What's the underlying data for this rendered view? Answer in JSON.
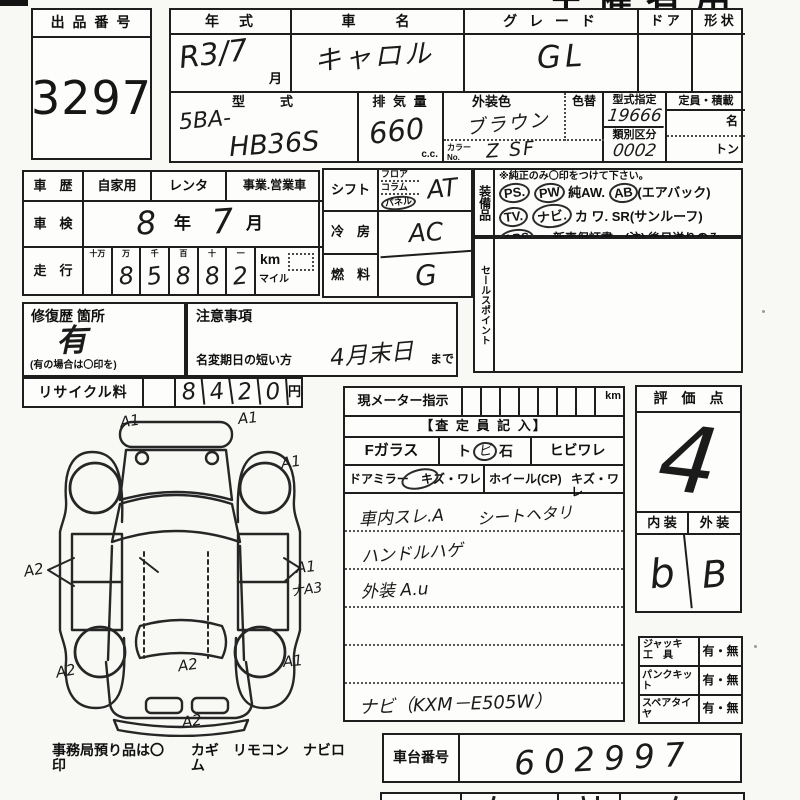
{
  "page": {
    "cut_title": "主催者用"
  },
  "lot": {
    "label": "出 品 番 号",
    "number": "3297"
  },
  "vehicle": {
    "year_label": "年　式",
    "year_value": "R3/7",
    "year_unit": "月",
    "name_label": "車　　名",
    "name_value": "キャロル",
    "grade_label": "グ レ ー ド",
    "grade_value": "GL",
    "door_label": "ド ア",
    "shape_label": "形 状",
    "model_label": "型　　式",
    "model_prefix": "5BA-",
    "model_code": "HB36S",
    "disp_label": "排 気 量",
    "disp_value": "660",
    "disp_unit": "c.c.",
    "color_label": "外装色",
    "color_change_label": "色替",
    "color_value": "ブラウン",
    "color_no_label": "カラーNo.",
    "color_no_value": "Z SF",
    "type_desig_label": "型式指定",
    "type_desig_value": "19666",
    "class_label": "類別区分",
    "class_value": "0002",
    "capacity_label": "定員・積載",
    "capacity_persons_unit": "名",
    "capacity_load_unit": "トン"
  },
  "history": {
    "label": "車　歴",
    "opt_private": "自家用",
    "opt_rental": "レンタ",
    "opt_commercial": "事業.営業車",
    "inspection_label": "車　検",
    "inspection_year": "8",
    "inspection_year_unit": "年",
    "inspection_month": "7",
    "inspection_month_unit": "月",
    "mileage_label": "走　行",
    "digit_headers": [
      "十万",
      "万",
      "千",
      "百",
      "十",
      "一"
    ],
    "digits": [
      "",
      "8",
      "5",
      "8",
      "8",
      "2"
    ],
    "unit_km": "km",
    "unit_mile": "マイル"
  },
  "repair": {
    "label": "修復歴 箇所",
    "value": "有",
    "note": "(有の場合は〇印を)"
  },
  "caution": {
    "label": "注意事項",
    "deadline_label": "名変期日の短い方",
    "deadline_value": "4月末日",
    "deadline_suffix": "まで"
  },
  "recycle": {
    "label": "リサイクル料",
    "digits": [
      "8",
      "4",
      "2",
      "0"
    ],
    "unit": "円"
  },
  "controls": {
    "shift_label": "シフト",
    "shift_options": [
      "フロア",
      "コラム",
      "パネル"
    ],
    "shift_value": "AT",
    "ac_label": "冷　房",
    "ac_value": "AC",
    "fuel_label": "燃　料",
    "fuel_value": "G"
  },
  "equipment": {
    "vlabel": "装備品",
    "note": "※純正のみ〇印をつけて下さい。",
    "l1": {
      "t1": "PS.",
      "t2": "PW",
      "t3": "純AW.",
      "t4": "AB",
      "t5": "(エアバック)"
    },
    "l2": {
      "t1": "TV.",
      "t2": "ナビ.",
      "t3": "カ ワ.",
      "t4": "SR(サンルーフ)"
    },
    "l3": {
      "t1": "ABS",
      "t2": "・ 新車保証書←(注) 後日送りのみ"
    }
  },
  "sales": {
    "vlabel": "セールスポイント"
  },
  "inspector": {
    "meter_label": "現メーター指示",
    "meter_unit": "km",
    "header": "【査 定 員 記 入】",
    "glass_label": "Fガラス",
    "stone_t1": "ト",
    "stone_t2": "ビ",
    "stone_t3": "石",
    "crack_label": "ヒビワレ",
    "mirror_label": "ドアミラー",
    "mirror_label2": "キズ・ワレ",
    "wheel_label": "ホイール(CP)",
    "wheel_label2": "キズ・ワレ",
    "note1a": "車内スレ.A",
    "note1b": "シートヘタリ",
    "note2": "ハンドルハゲ",
    "note3": "外装 A.u",
    "note6": "ナビ（KXM－E505W）"
  },
  "evaluation": {
    "label": "評　価　点",
    "score": "4",
    "interior_label": "内 装",
    "exterior_label": "外 装",
    "interior_value": "b",
    "exterior_value": "B"
  },
  "accessories": {
    "jack_label": "ジャッキ",
    "jack_label2": "工　具",
    "jack_value": "有・無",
    "puncture_label": "パンクキット",
    "puncture_value": "有・無",
    "spare_label": "スペアタイヤ",
    "spare_value": "有・無"
  },
  "chassis": {
    "label": "車台番号",
    "value": "602997"
  },
  "diagram": {
    "marks": [
      "A1",
      "A1",
      "A1",
      "A2",
      "A1",
      "ナA3",
      "A2",
      "A2",
      "A1",
      "A2"
    ],
    "footer_a": "事務局預り品は〇印",
    "footer_b": "カギ　リモコン　ナビロム"
  }
}
